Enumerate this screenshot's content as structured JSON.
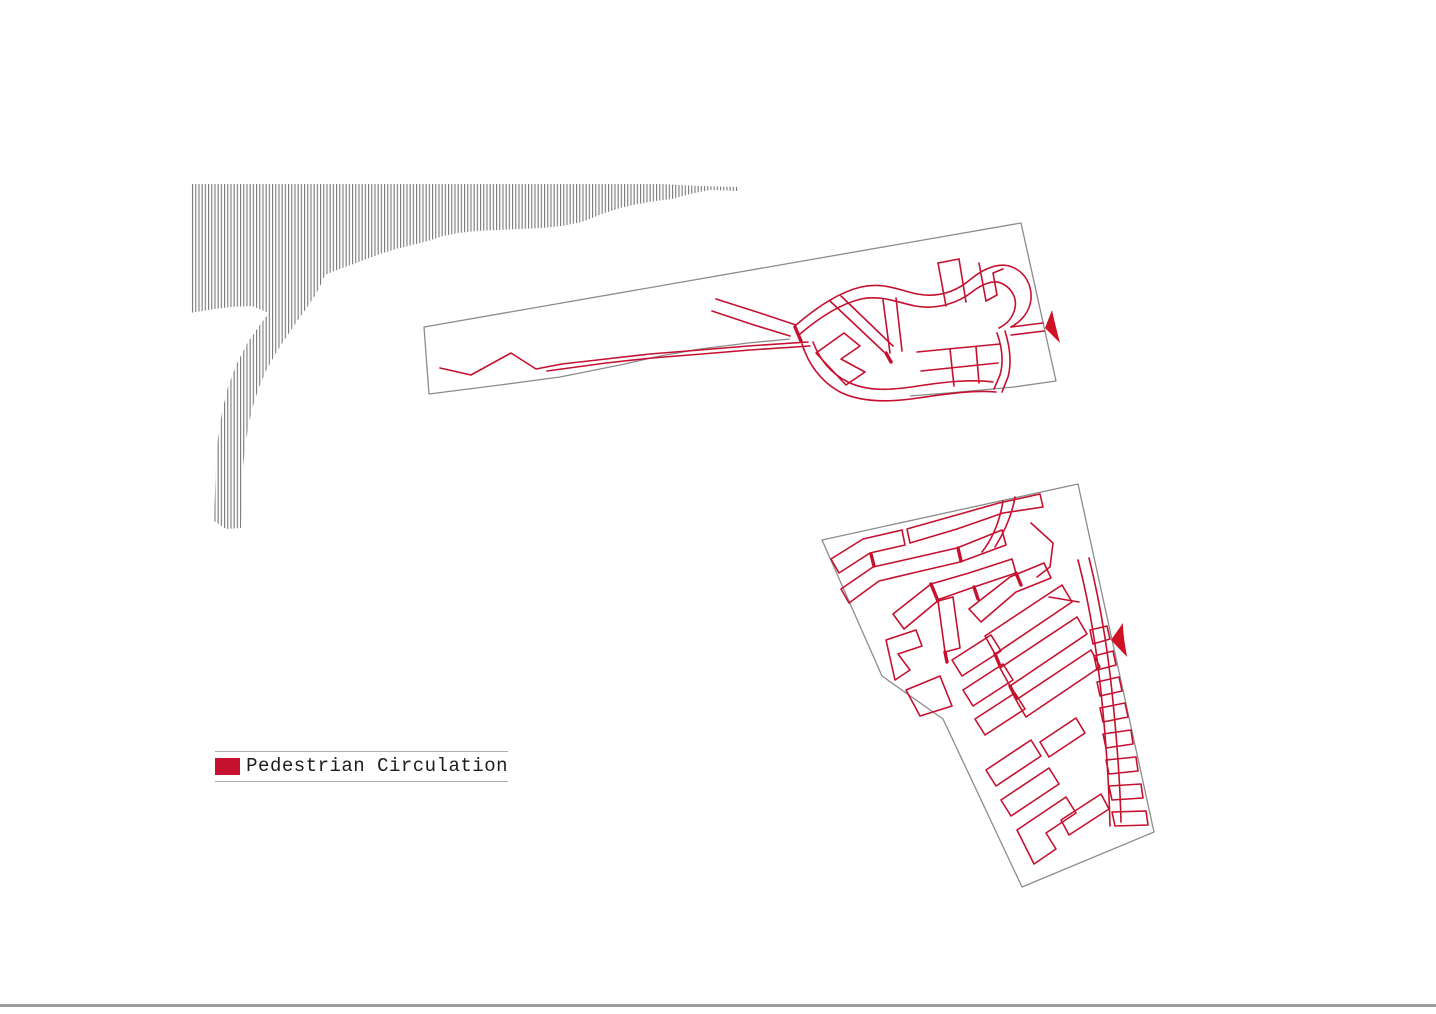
{
  "legend": {
    "label": "Pedestrian Circulation",
    "swatch_color": "#c5102f"
  },
  "colors": {
    "circulation_red": "#c5102f",
    "north_arrow_red": "#cf1126",
    "site_outline_gray": "#8c8c8c",
    "shoreline_hatch_gray": "#787878",
    "legend_rule_gray": "#aeaeae",
    "footer_rule_gray": "#9b9b9b",
    "text_color": "#1c1c1c"
  },
  "icons": {
    "north_arrow": "solid red triangular pennant pointing left",
    "shoreline_hatch": "fine vertical-line hatch band (coastline)"
  },
  "diagram": {
    "type": "architectural site analysis plate",
    "site_count": 2,
    "upper_site": "elongated waterfront strip plan with red pedestrian path network and north arrow at right edge",
    "lower_site": "polygonal district plan filled with red pedestrian block network and north arrow at right edge"
  }
}
